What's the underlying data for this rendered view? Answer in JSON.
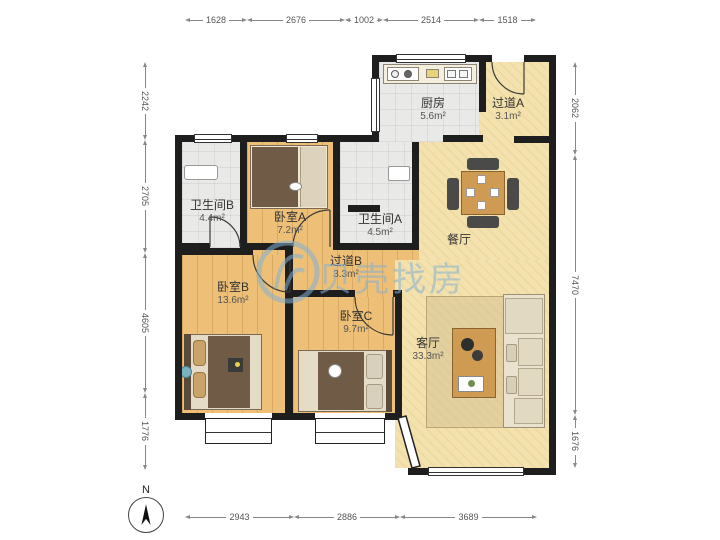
{
  "watermark": {
    "text": "贝壳找房",
    "logo": "beike-shell-logo",
    "color": "#84b0d3"
  },
  "compass": {
    "north_label": "N"
  },
  "dims": {
    "top": [
      "1628",
      "2676",
      "1002",
      "2514",
      "1518"
    ],
    "left": [
      "2242",
      "2705",
      "4605",
      "1776"
    ],
    "right": [
      "2062",
      "7470",
      "1676"
    ],
    "bottom": [
      "2943",
      "2886",
      "3689"
    ]
  },
  "rooms": {
    "kitchen": {
      "name": "厨房",
      "area": "5.6m²"
    },
    "hallway_a": {
      "name": "过道A",
      "area": "3.1m²"
    },
    "bathroom_b": {
      "name": "卫生间B",
      "area": "4.4m²"
    },
    "bedroom_a": {
      "name": "卧室A",
      "area": "7.2m²"
    },
    "bathroom_a": {
      "name": "卫生间A",
      "area": "4.5m²"
    },
    "dining": {
      "name": "餐厅"
    },
    "hallway_b": {
      "name": "过道B",
      "area": "3.3m²"
    },
    "bedroom_b": {
      "name": "卧室B",
      "area": "13.6m²"
    },
    "bedroom_c": {
      "name": "卧室C",
      "area": "9.7m²"
    },
    "living": {
      "name": "客厅",
      "area": "33.3m²"
    }
  },
  "colors": {
    "wall": "#1e1e1e",
    "wood_floor": "#edbf77",
    "tan_floor": "#f4e2ae",
    "tile_floor": "#e9e9e7",
    "duvet": "#6f5b46",
    "table_wood": "#cf9a52"
  }
}
